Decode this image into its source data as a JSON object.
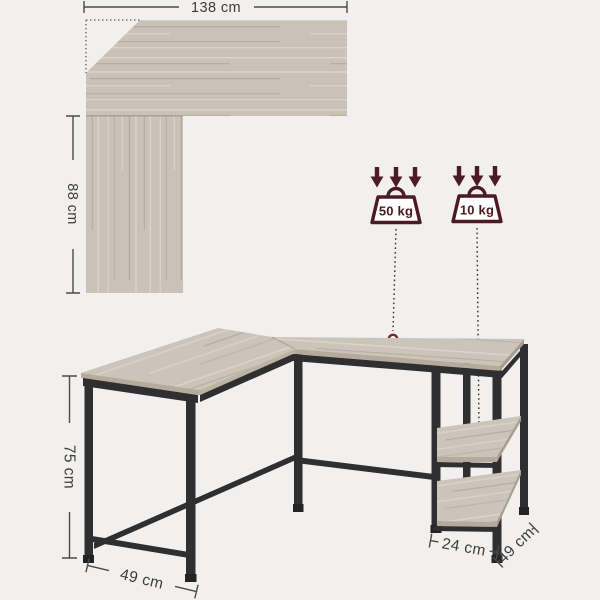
{
  "product": "L-shaped computer desk with shelves — dimension diagram",
  "colors": {
    "background": "#f1f0ee",
    "wood": "#cac2b6",
    "wood_edge": "#b5ab9d",
    "metal_frame": "#2f2f31",
    "dimension_lines": "#4a4a4a",
    "accent_maroon": "#4c1a24",
    "marker_red": "#7c2530"
  },
  "icons": {
    "load_arrows": "down-arrows-icon",
    "load_weight": "weight-icon",
    "load_point": "target-point-marker"
  },
  "top_view": {
    "width_label": "138 cm",
    "depth_label": "88 cm"
  },
  "load_badges": [
    {
      "label": "50 kg",
      "applies_to": "desktop"
    },
    {
      "label": "10 kg",
      "applies_to": "shelf"
    }
  ],
  "side_view": {
    "height_label": "75 cm",
    "end_depth_label": "49 cm",
    "shelf_width_label": "24 cm",
    "shelf_depth_label": "49 cm"
  }
}
